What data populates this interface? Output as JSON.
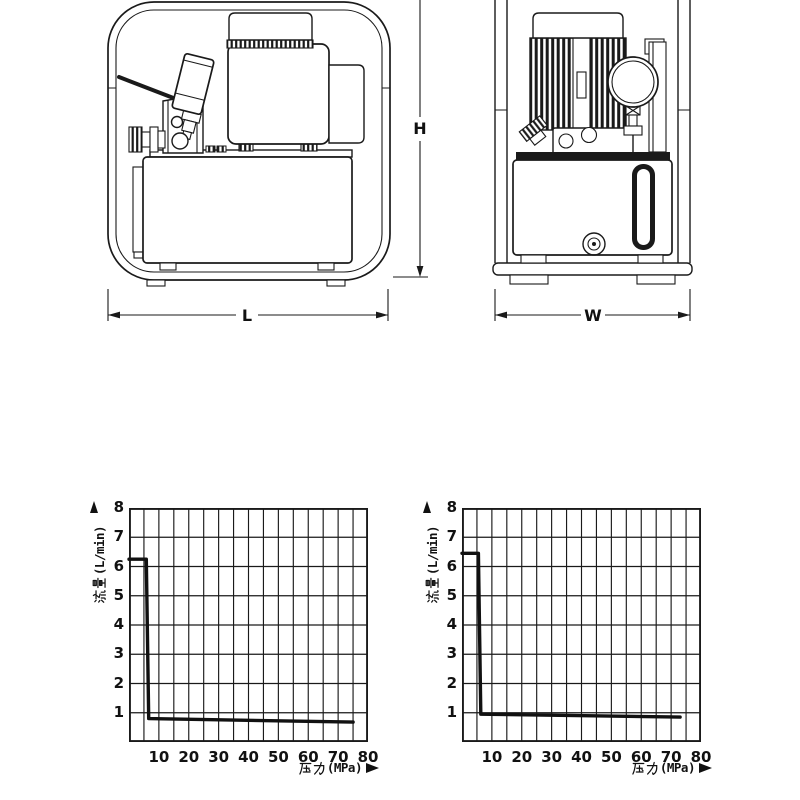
{
  "page": {
    "background": "#ffffff",
    "ink": "#1a1a1a"
  },
  "drawings": {
    "side_view": {
      "name": "hydraulic-pump-side-view"
    },
    "front_view": {
      "name": "hydraulic-pump-front-view"
    },
    "dimensions": {
      "height_label": "H",
      "length_label": "L",
      "width_label": "W"
    }
  },
  "chart_data": [
    {
      "type": "line",
      "title": "",
      "xlabel": "压力(MPa)",
      "xlabel_cjk": "压力",
      "xlabel_suffix": "(MPa)",
      "ylabel": "流量(L/min)",
      "ylabel_cjk": "流量",
      "ylabel_suffix": "(L/min)",
      "xlim": [
        0,
        80
      ],
      "ylim": [
        0,
        8
      ],
      "x_gridstep": 5,
      "y_gridstep": 1,
      "xticks": [
        10,
        20,
        30,
        40,
        50,
        60,
        70,
        80
      ],
      "yticks": [
        8,
        7,
        6,
        5,
        4,
        3,
        2,
        1
      ],
      "grid": true,
      "legend": "none",
      "line_color": "#111111",
      "series": [
        {
          "name": "flow-vs-pressure",
          "points": [
            [
              0,
              6.25
            ],
            [
              5.8,
              6.25
            ],
            [
              6.6,
              0.8
            ],
            [
              75,
              0.68
            ]
          ]
        }
      ]
    },
    {
      "type": "line",
      "title": "",
      "xlabel": "压力(MPa)",
      "xlabel_cjk": "压力",
      "xlabel_suffix": "(MPa)",
      "ylabel": "流量(L/min)",
      "ylabel_cjk": "流量",
      "ylabel_suffix": "(L/min)",
      "xlim": [
        0,
        80
      ],
      "ylim": [
        0,
        8
      ],
      "x_gridstep": 5,
      "y_gridstep": 1,
      "xticks": [
        10,
        20,
        30,
        40,
        50,
        60,
        70,
        80
      ],
      "yticks": [
        8,
        7,
        6,
        5,
        4,
        3,
        2,
        1
      ],
      "grid": true,
      "legend": "none",
      "line_color": "#111111",
      "series": [
        {
          "name": "flow-vs-pressure",
          "points": [
            [
              0,
              6.45
            ],
            [
              5.5,
              6.45
            ],
            [
              6.3,
              0.95
            ],
            [
              73,
              0.85
            ]
          ]
        }
      ]
    }
  ]
}
